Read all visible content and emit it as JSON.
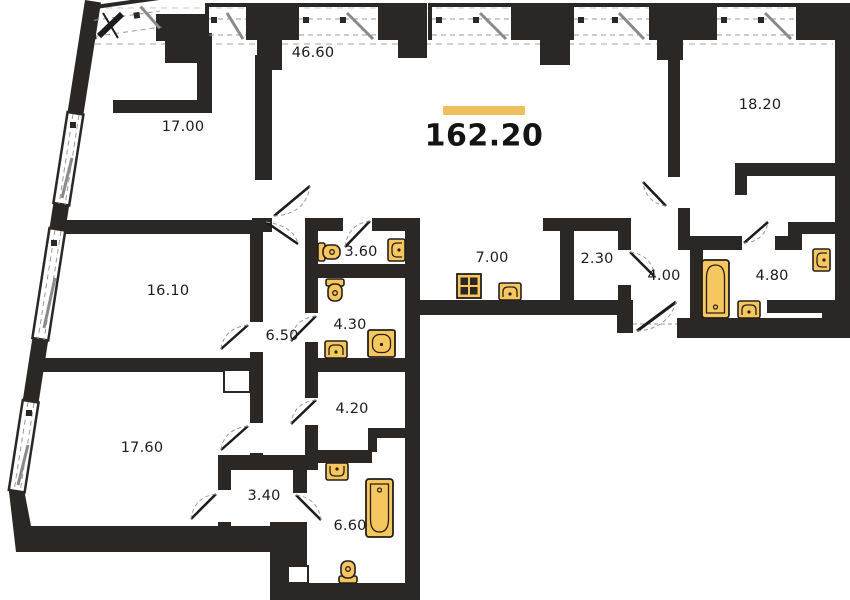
{
  "title": "Apartment floor plan",
  "total": {
    "area": "162.20"
  },
  "accent_color": "#EDC05B",
  "wall_color": "#2B2724",
  "fixture_fill": "#F7C75F",
  "rooms": [
    {
      "id": "room-17-00",
      "area": "17.00"
    },
    {
      "id": "room-46-60",
      "area": "46.60"
    },
    {
      "id": "room-18-20",
      "area": "18.20"
    },
    {
      "id": "room-16-10",
      "area": "16.10"
    },
    {
      "id": "corridor-6-50",
      "area": "6.50"
    },
    {
      "id": "bath-3-60",
      "area": "3.60"
    },
    {
      "id": "kitchen-7-00",
      "area": "7.00"
    },
    {
      "id": "closet-2-30",
      "area": "2.30"
    },
    {
      "id": "hall-4-00",
      "area": "4.00"
    },
    {
      "id": "bath-4-80",
      "area": "4.80"
    },
    {
      "id": "bath-4-30",
      "area": "4.30"
    },
    {
      "id": "room-4-20",
      "area": "4.20"
    },
    {
      "id": "room-17-60",
      "area": "17.60"
    },
    {
      "id": "closet-3-40",
      "area": "3.40"
    },
    {
      "id": "bath-6-60",
      "area": "6.60"
    }
  ],
  "fixture_types": [
    "bathtub",
    "toilet",
    "sink",
    "stove",
    "shower"
  ],
  "feature_types": [
    "window",
    "door"
  ]
}
